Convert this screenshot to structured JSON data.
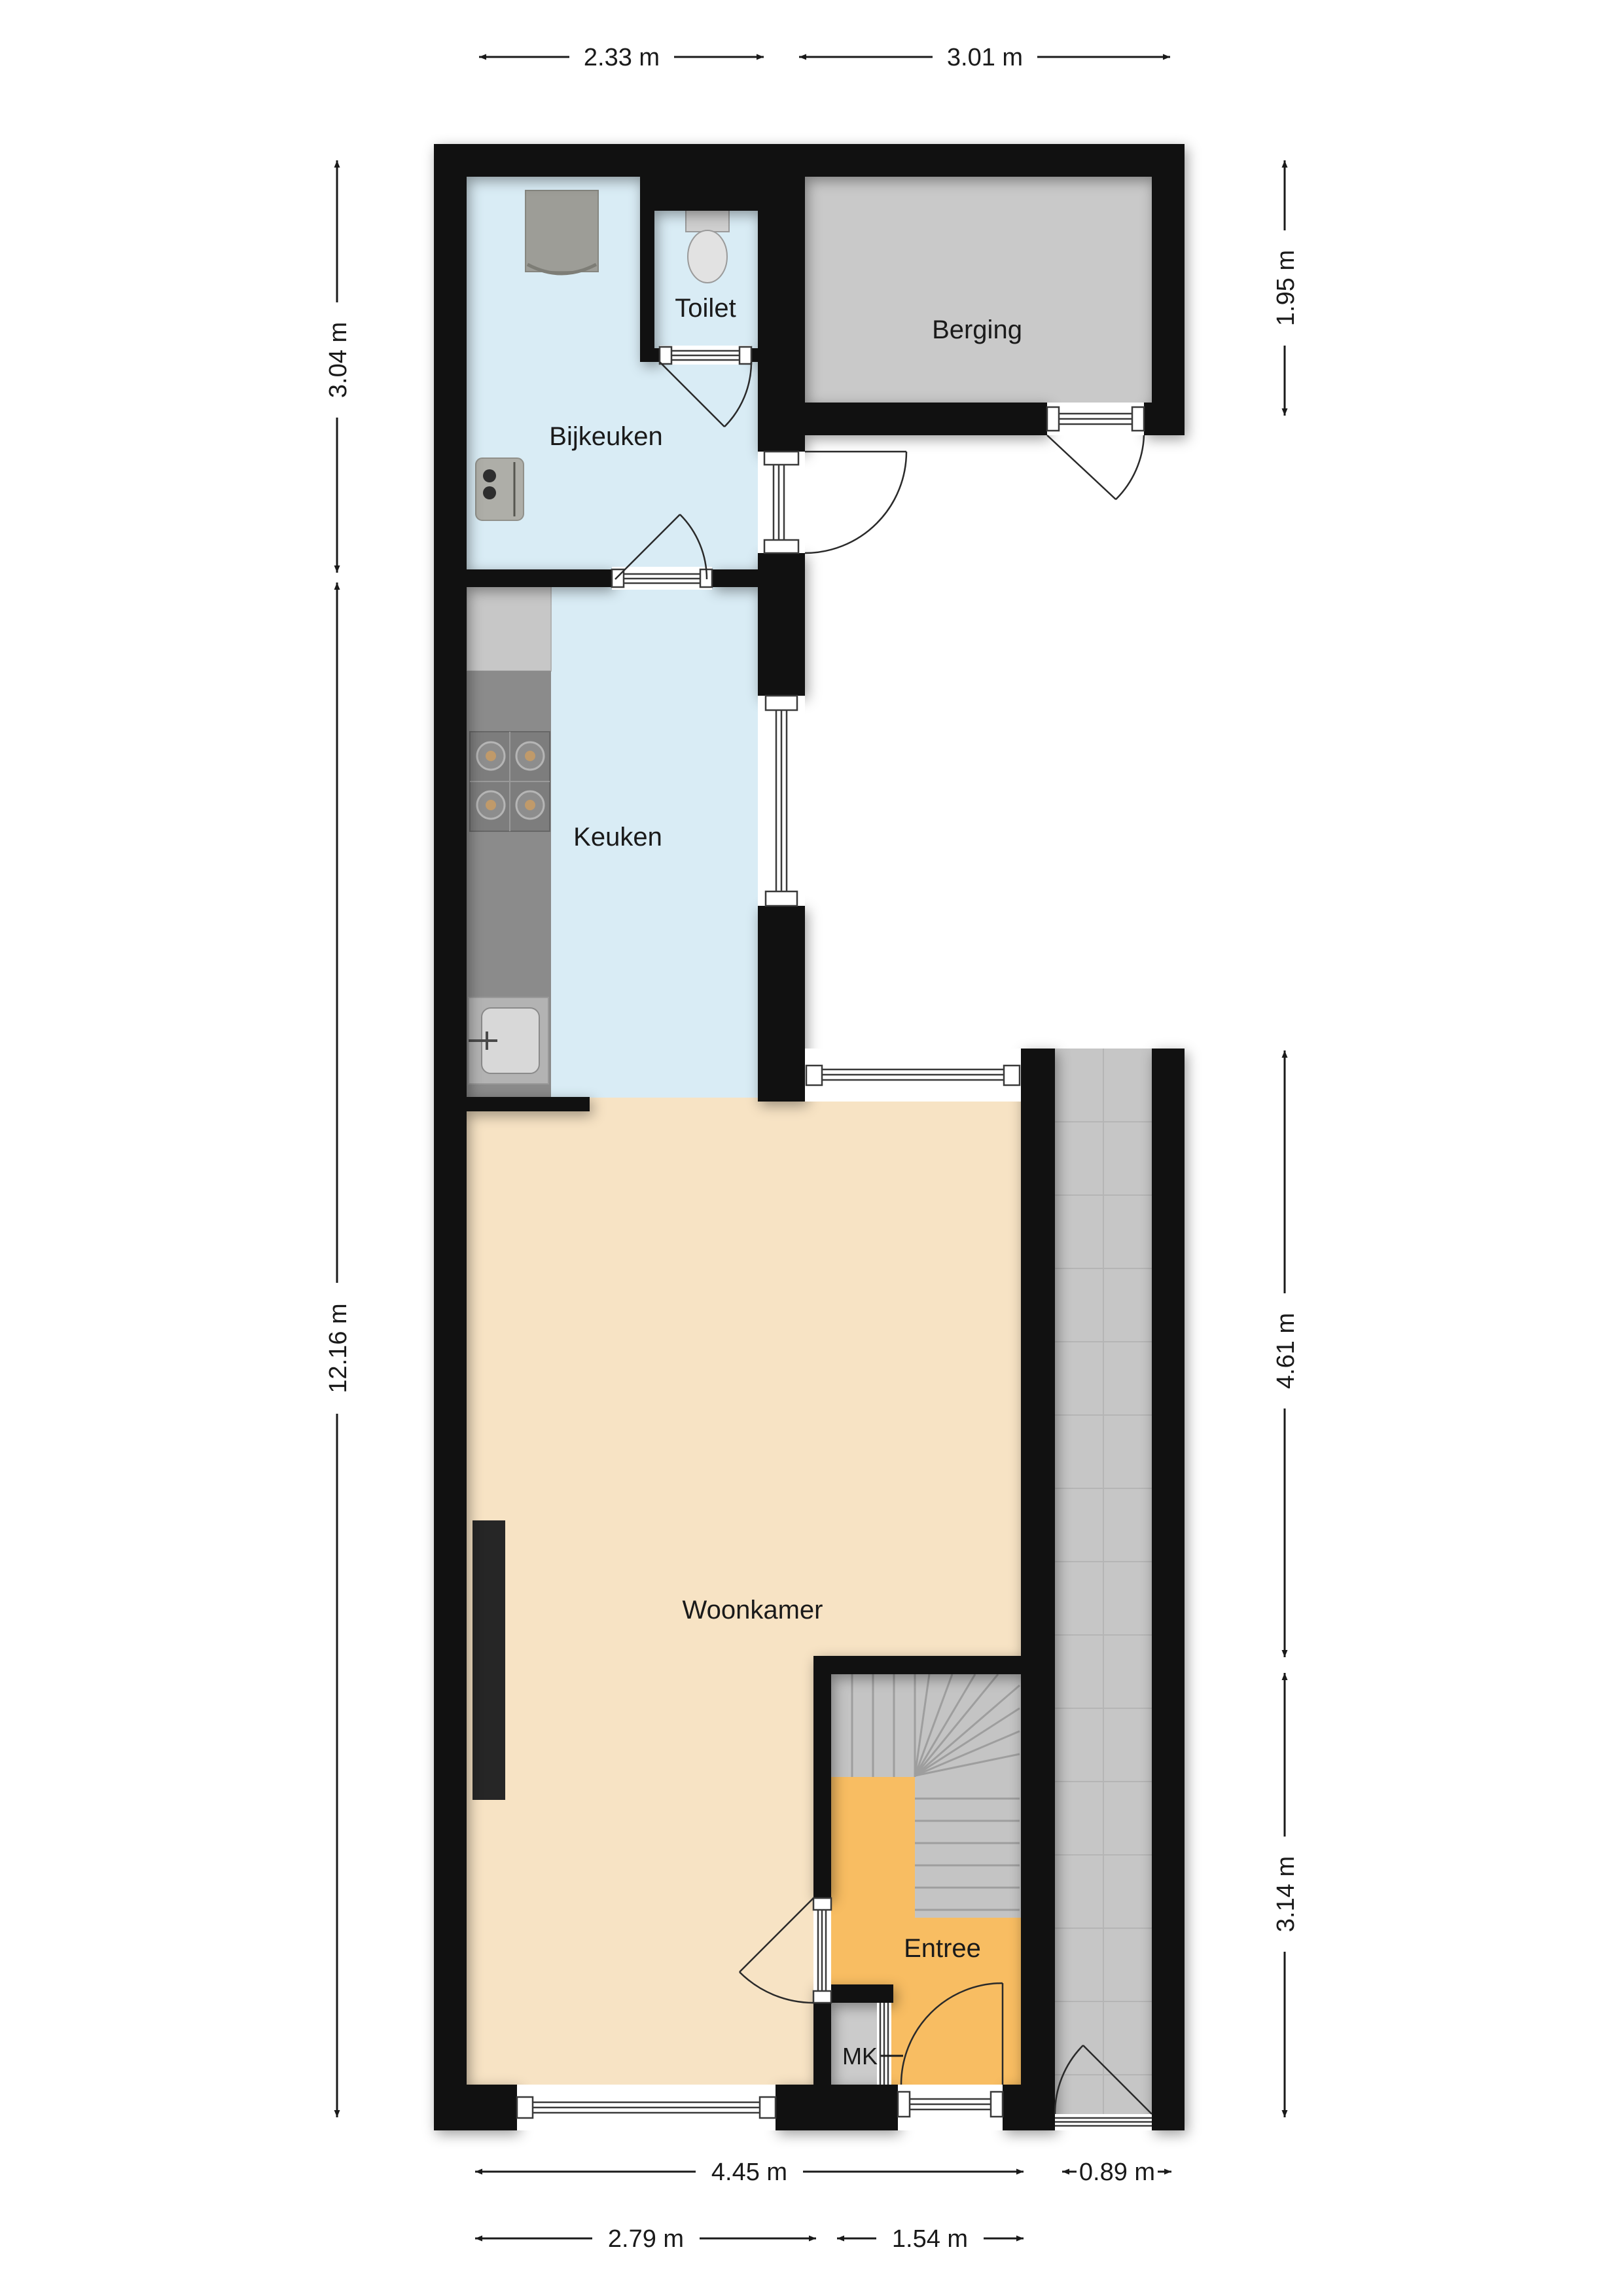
{
  "rooms": [
    {
      "id": "bijkeuken",
      "label": "Bijkeuken"
    },
    {
      "id": "toilet",
      "label": "Toilet"
    },
    {
      "id": "berging",
      "label": "Berging"
    },
    {
      "id": "keuken",
      "label": "Keuken"
    },
    {
      "id": "woonkamer",
      "label": "Woonkamer"
    },
    {
      "id": "entree",
      "label": "Entree"
    },
    {
      "id": "meterkast",
      "label": "MK"
    }
  ],
  "dimensions": {
    "top": [
      {
        "label": "2.33 m"
      },
      {
        "label": "3.01 m"
      }
    ],
    "left": [
      {
        "label": "3.04 m"
      },
      {
        "label": "12.16 m"
      }
    ],
    "right": [
      {
        "label": "1.95 m"
      },
      {
        "label": "4.61 m"
      },
      {
        "label": "3.14 m"
      }
    ],
    "bottom_row1": [
      {
        "label": "4.45 m"
      },
      {
        "label": "0.89 m"
      }
    ],
    "bottom_row2": [
      {
        "label": "2.79 m"
      },
      {
        "label": "1.54 m"
      }
    ]
  },
  "colors": {
    "wall": "#111111",
    "wet_room_floor": "#d9ecf5",
    "living_room_floor": "#f7e3c4",
    "entree_floor": "#f8bd62",
    "berging_floor": "#c9c9c9",
    "outdoor_tiles": "#c6c6c6",
    "stairs": "#c4c4c4"
  }
}
